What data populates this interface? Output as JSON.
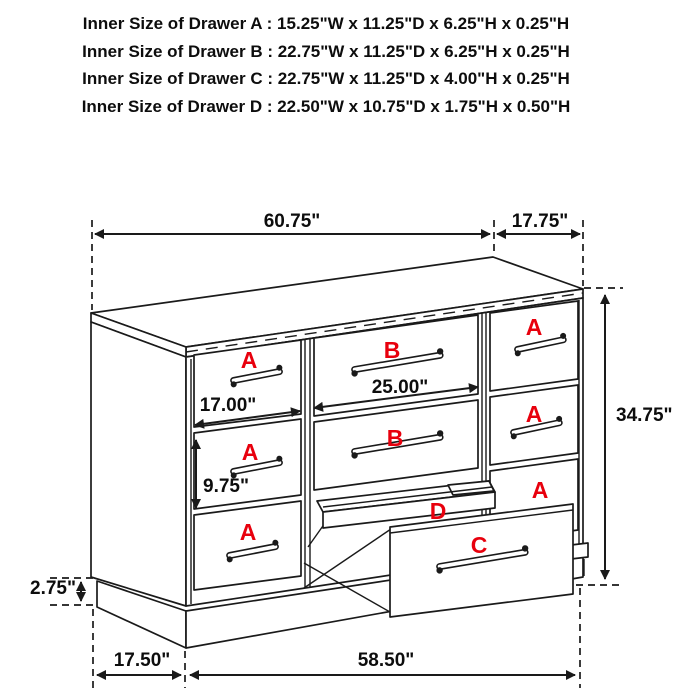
{
  "header": {
    "lines": [
      "Inner Size of Drawer A : 15.25\"W x 11.25\"D x 6.25\"H x 0.25\"H",
      "Inner Size of Drawer B : 22.75\"W x 11.25\"D x 6.25\"H x 0.25\"H",
      "Inner Size of Drawer C : 22.75\"W x 11.25\"D x 4.00\"H x 0.25\"H",
      "Inner Size of Drawer D : 22.50\"W x 10.75\"D x 1.75\"H x 0.50\"H"
    ]
  },
  "drawer_labels": {
    "a": "A",
    "b": "B",
    "c": "C",
    "d": "D"
  },
  "dimensions": {
    "top_width": "60.75\"",
    "top_depth": "17.75\"",
    "overall_height": "34.75\"",
    "drawer_a_width": "17.00\"",
    "drawer_b_width": "25.00\"",
    "drawer_a_height": "9.75\"",
    "base_height": "2.75\"",
    "base_side_depth": "17.50\"",
    "base_front_width": "58.50\""
  },
  "colors": {
    "background": "#ffffff",
    "line_art": "#1a1a1a",
    "drawer_label_red": "#e8000d"
  }
}
